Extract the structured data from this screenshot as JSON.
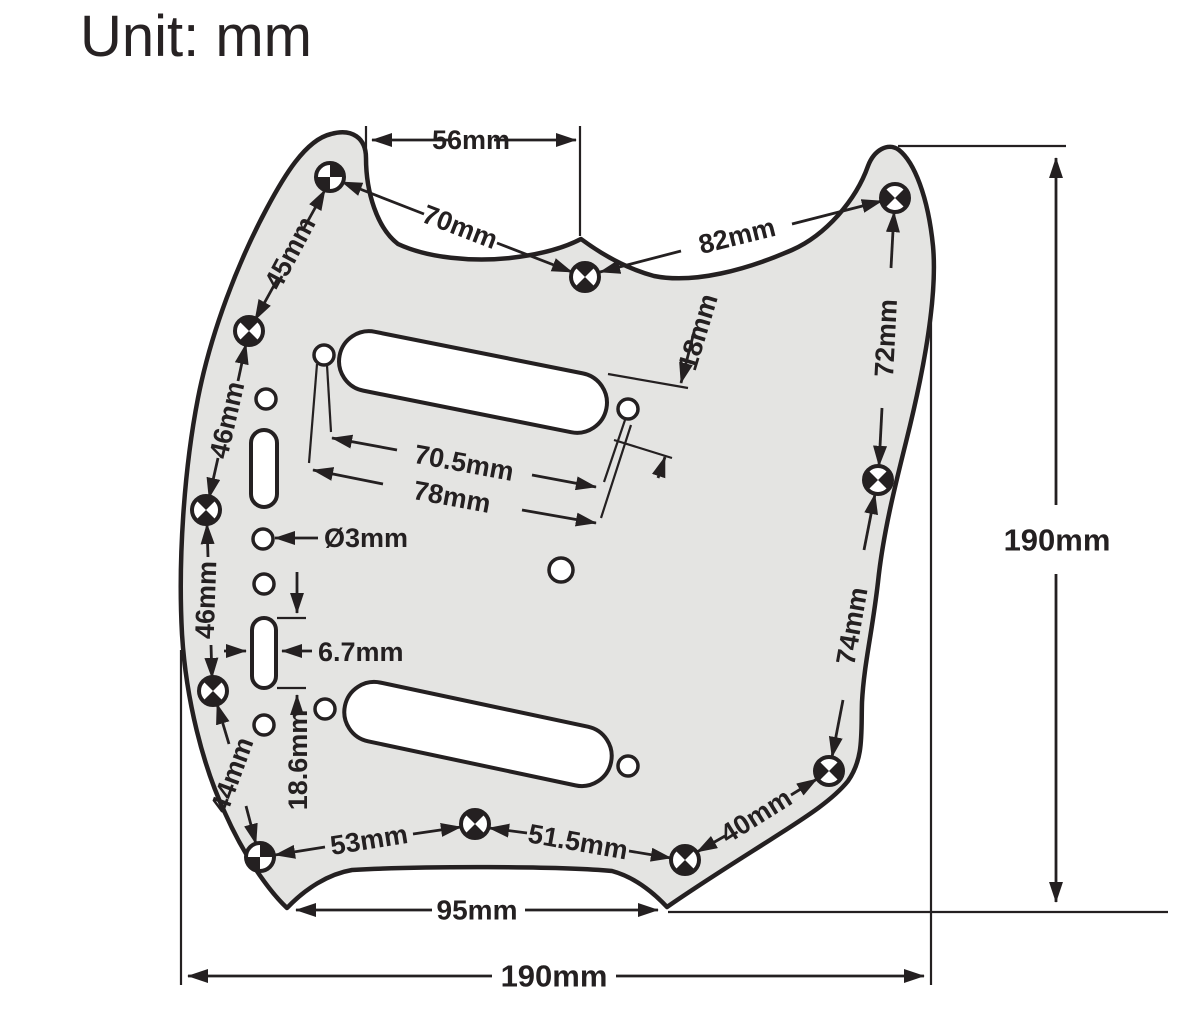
{
  "title": "Unit: mm",
  "colors": {
    "line": "#242021",
    "pickguard_fill": "#e4e4e2",
    "background": "#ffffff"
  },
  "dims": {
    "top_edge_56": "56mm",
    "diag_70": "70mm",
    "diag_82": "82mm",
    "left_45": "45mm",
    "left_46a": "46mm",
    "left_46b": "46mm",
    "left_44": "44mm",
    "bottom_53": "53mm",
    "bottom_51_5": "51.5mm",
    "bottom_40": "40mm",
    "right_74": "74mm",
    "right_72": "72mm",
    "pickup_width_18": "18mm",
    "pickup_screws_70_5": "70.5mm",
    "pickup_slot_78": "78mm",
    "hole_dia_3": "Ø3mm",
    "slot_width_6_7": "6.7mm",
    "slot_span_18_6": "18.6mm",
    "notch_95": "95mm",
    "total_width_190": "190mm",
    "total_height_190": "190mm"
  }
}
